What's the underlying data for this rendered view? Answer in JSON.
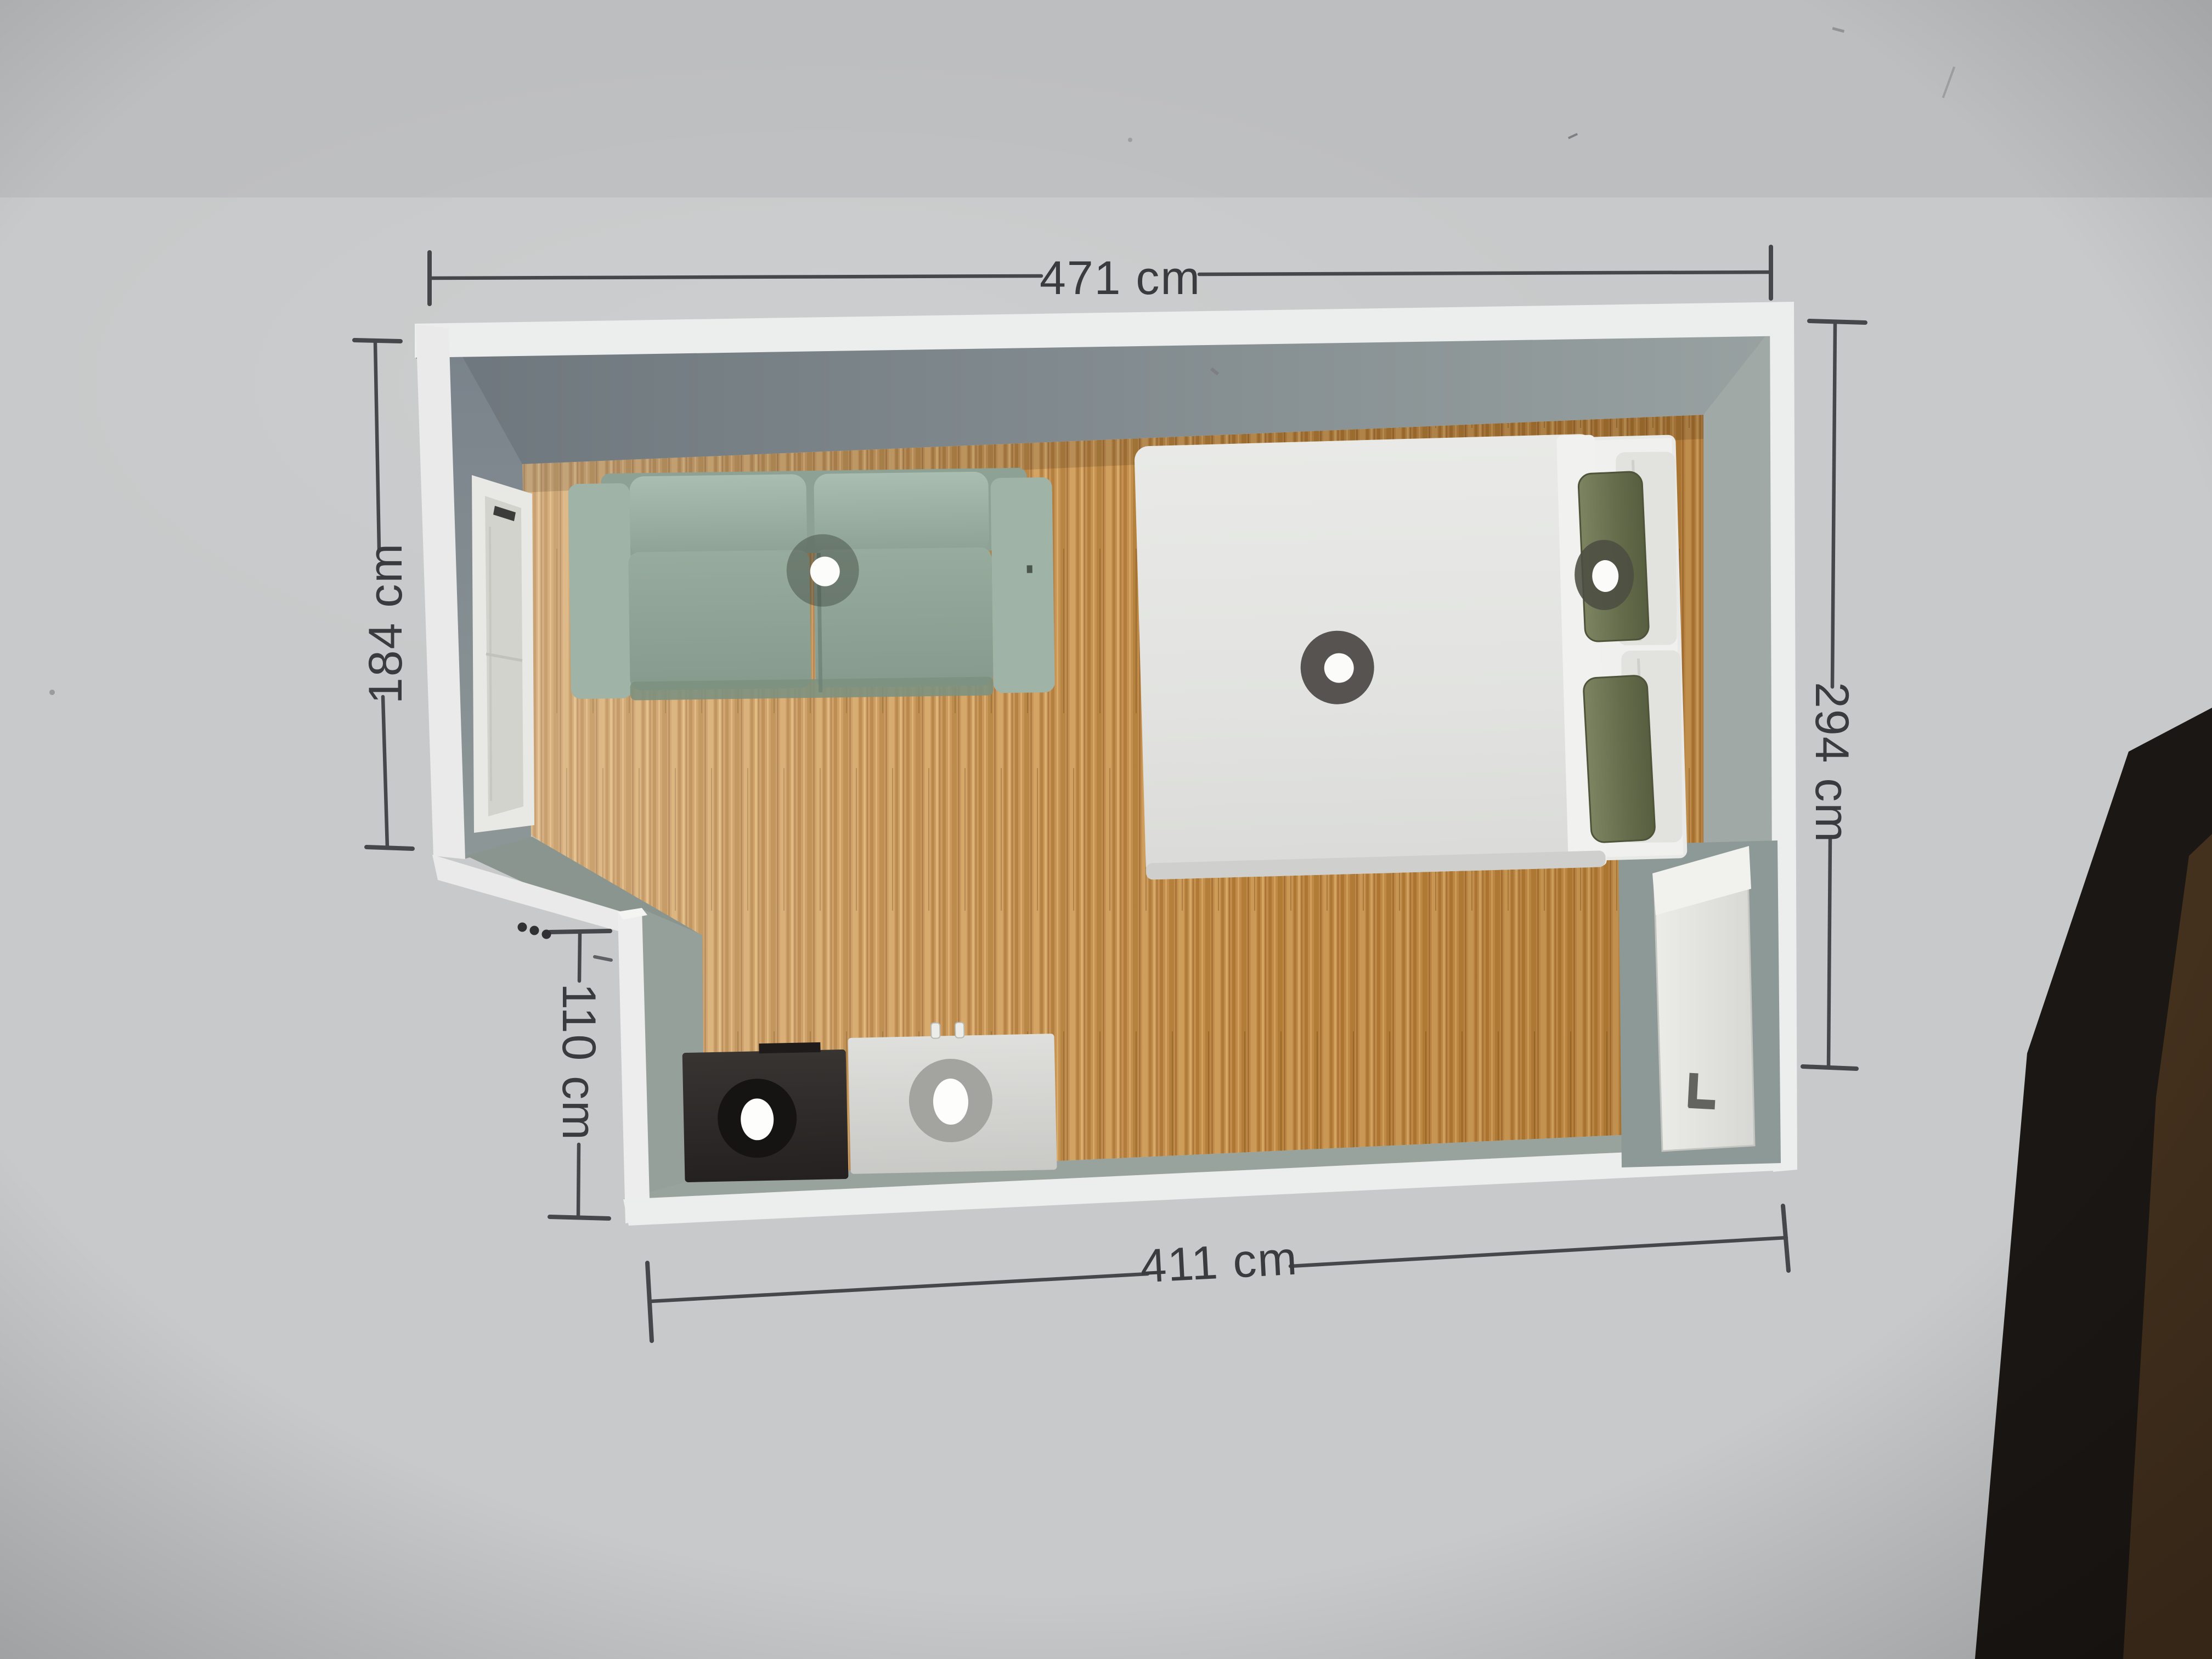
{
  "dimensions": {
    "top": {
      "label": "471 cm",
      "value": 471,
      "unit": "cm"
    },
    "left": {
      "label": "184 cm",
      "value": 184,
      "unit": "cm"
    },
    "right": {
      "label": "294 cm",
      "value": 294,
      "unit": "cm"
    },
    "alcove": {
      "label": "110 cm",
      "value": 110,
      "unit": "cm"
    },
    "bottom": {
      "label": "411 cm",
      "value": 411,
      "unit": "cm"
    }
  },
  "icons": {
    "overflow_menu": "three-dots-horizontal",
    "selection_handle": "dark-circle-white-dot",
    "door_handle": "l-shaped-handle"
  },
  "furniture": [
    {
      "name": "sofa",
      "type": "loveseat",
      "color": "#93a899",
      "selected": true
    },
    {
      "name": "double-bed",
      "type": "bed",
      "color": "#e4e5e2",
      "selected": true
    },
    {
      "name": "olive-pillow",
      "type": "cushion",
      "color": "#6e7555",
      "selected": true
    },
    {
      "name": "dark-cabinet",
      "type": "cabinet",
      "color": "#2b2827",
      "selected": true
    },
    {
      "name": "light-cabinet",
      "type": "cabinet",
      "color": "#d8d8d5",
      "selected": true
    }
  ],
  "room": {
    "floor_color": "#c08b4a",
    "wall_face_color": "#87929a",
    "wall_top_color": "#ededec",
    "background_color": "#c7c9ca",
    "dimension_color": "#46474a",
    "features": [
      "window-west-wall",
      "door-south-east",
      "alcove-south-west"
    ]
  }
}
